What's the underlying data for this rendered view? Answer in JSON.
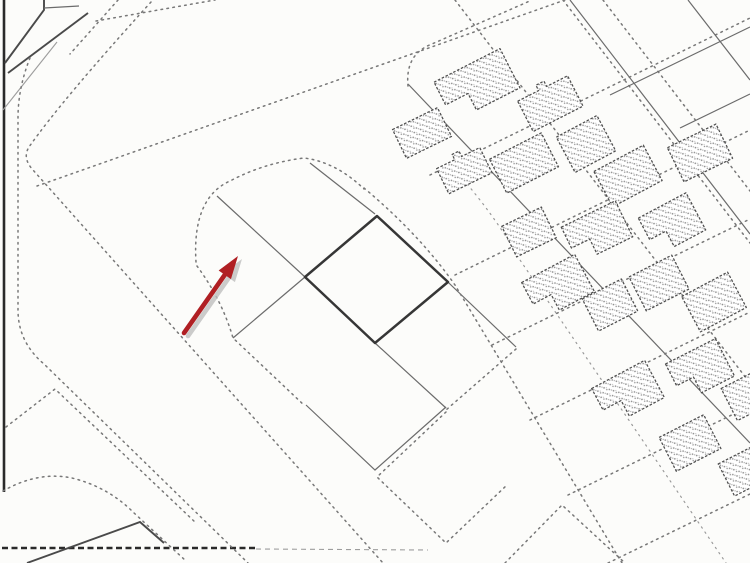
{
  "map": {
    "kind": "scanned cadastral plot plan",
    "colors": {
      "paper": "#fcfcfa",
      "ink": "#4a4a4a",
      "ink-light": "#787878",
      "ink-dark": "#363636",
      "border": "#2a2a2a",
      "stipple": "#8f8f8f",
      "arrow": "#b01f23",
      "arrow-shadow": "#bfbfbf"
    },
    "marker": {
      "tail": [
        184,
        333
      ],
      "tip": [
        238,
        256
      ],
      "shaft_width": 4.6,
      "head_length": 23,
      "head_half_width": 7.5,
      "shadow_offset": [
        4,
        3
      ]
    },
    "highlighted_plot": {
      "points": "377,216 448,282 375,343 305,277"
    },
    "buildings": [
      {
        "cx": 477,
        "cy": 85,
        "w": 74,
        "h": 44,
        "a": -27,
        "shape": "L"
      },
      {
        "cx": 422,
        "cy": 133,
        "w": 50,
        "h": 32,
        "a": -26,
        "shape": "R"
      },
      {
        "cx": 549,
        "cy": 101,
        "w": 56,
        "h": 40,
        "a": -27,
        "shape": "T"
      },
      {
        "cx": 524,
        "cy": 163,
        "w": 58,
        "h": 38,
        "a": -27,
        "shape": "R"
      },
      {
        "cx": 463,
        "cy": 168,
        "w": 48,
        "h": 34,
        "a": -26,
        "shape": "T"
      },
      {
        "cx": 586,
        "cy": 144,
        "w": 46,
        "h": 40,
        "a": -28,
        "shape": "R"
      },
      {
        "cx": 628,
        "cy": 176,
        "w": 56,
        "h": 40,
        "a": -28,
        "shape": "R"
      },
      {
        "cx": 700,
        "cy": 153,
        "w": 54,
        "h": 38,
        "a": -26,
        "shape": "R"
      },
      {
        "cx": 672,
        "cy": 224,
        "w": 54,
        "h": 42,
        "a": -28,
        "shape": "L"
      },
      {
        "cx": 597,
        "cy": 232,
        "w": 60,
        "h": 40,
        "a": -26,
        "shape": "L"
      },
      {
        "cx": 529,
        "cy": 232,
        "w": 44,
        "h": 34,
        "a": -26,
        "shape": "R"
      },
      {
        "cx": 558,
        "cy": 287,
        "w": 60,
        "h": 42,
        "a": -28,
        "shape": "L"
      },
      {
        "cx": 610,
        "cy": 305,
        "w": 44,
        "h": 36,
        "a": -27,
        "shape": "R"
      },
      {
        "cx": 659,
        "cy": 283,
        "w": 48,
        "h": 38,
        "a": -27,
        "shape": "R"
      },
      {
        "cx": 714,
        "cy": 302,
        "w": 52,
        "h": 40,
        "a": -28,
        "shape": "R"
      },
      {
        "cx": 700,
        "cy": 370,
        "w": 56,
        "h": 42,
        "a": -27,
        "shape": "L"
      },
      {
        "cx": 748,
        "cy": 395,
        "w": 42,
        "h": 36,
        "a": -27,
        "shape": "R"
      },
      {
        "cx": 628,
        "cy": 393,
        "w": 60,
        "h": 42,
        "a": -28,
        "shape": "L"
      },
      {
        "cx": 690,
        "cy": 443,
        "w": 50,
        "h": 38,
        "a": -27,
        "shape": "R"
      },
      {
        "cx": 746,
        "cy": 470,
        "w": 44,
        "h": 36,
        "a": -27,
        "shape": "R"
      }
    ],
    "building_count": 20
  }
}
